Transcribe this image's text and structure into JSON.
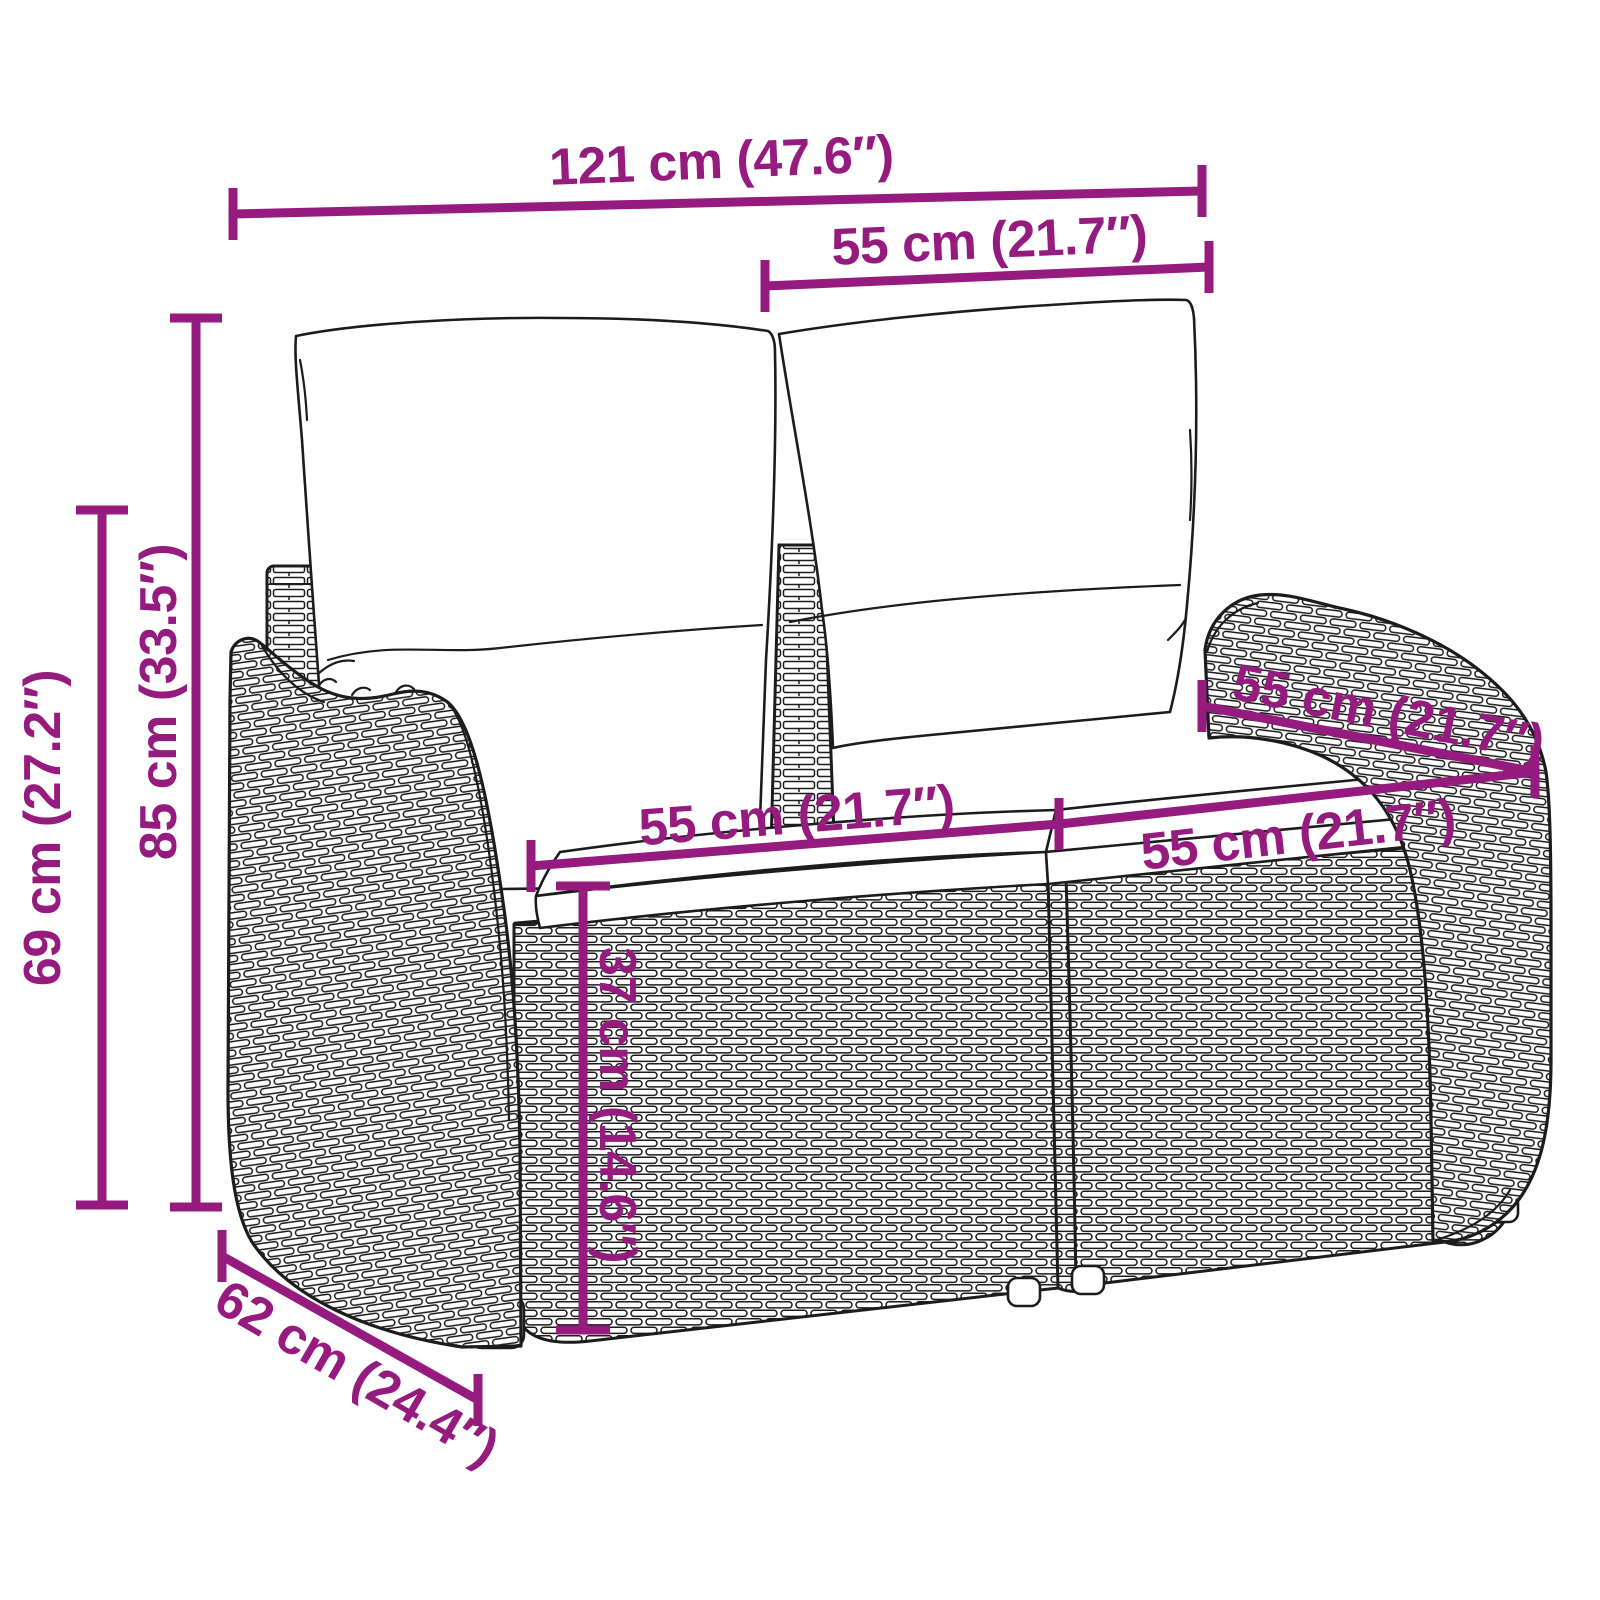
{
  "diagram": {
    "type": "product-dimension-diagram",
    "subject": "rattan-two-seater-garden-bench-with-cushions",
    "background_color": "#ffffff",
    "dimension_color": "#951B7E",
    "outline_color": "#1c1c1c",
    "dimensions": [
      {
        "id": "width-total",
        "label": "121 cm (47.6″)",
        "cm": 121,
        "inches": 47.6,
        "orientation": "horizontal"
      },
      {
        "id": "width-back-section",
        "label": "55 cm (21.7″)",
        "cm": 55,
        "inches": 21.7,
        "orientation": "horizontal"
      },
      {
        "id": "height-total",
        "label": "85 cm (33.5″)",
        "cm": 85,
        "inches": 33.5,
        "orientation": "vertical"
      },
      {
        "id": "height-armrest",
        "label": "69 cm (27.2″)",
        "cm": 69,
        "inches": 27.2,
        "orientation": "vertical"
      },
      {
        "id": "seat-width-left",
        "label": "55 cm (21.7″)",
        "cm": 55,
        "inches": 21.7,
        "orientation": "horizontal"
      },
      {
        "id": "seat-width-right",
        "label": "55 cm (21.7″)",
        "cm": 55,
        "inches": 21.7,
        "orientation": "horizontal"
      },
      {
        "id": "seat-depth",
        "label": "55 cm (21.7″)",
        "cm": 55,
        "inches": 21.7,
        "orientation": "diagonal"
      },
      {
        "id": "seat-height",
        "label": "37 cm (14.6″)",
        "cm": 37,
        "inches": 14.6,
        "orientation": "vertical"
      },
      {
        "id": "depth-total",
        "label": "62 cm (24.4″)",
        "cm": 62,
        "inches": 24.4,
        "orientation": "diagonal"
      }
    ]
  }
}
